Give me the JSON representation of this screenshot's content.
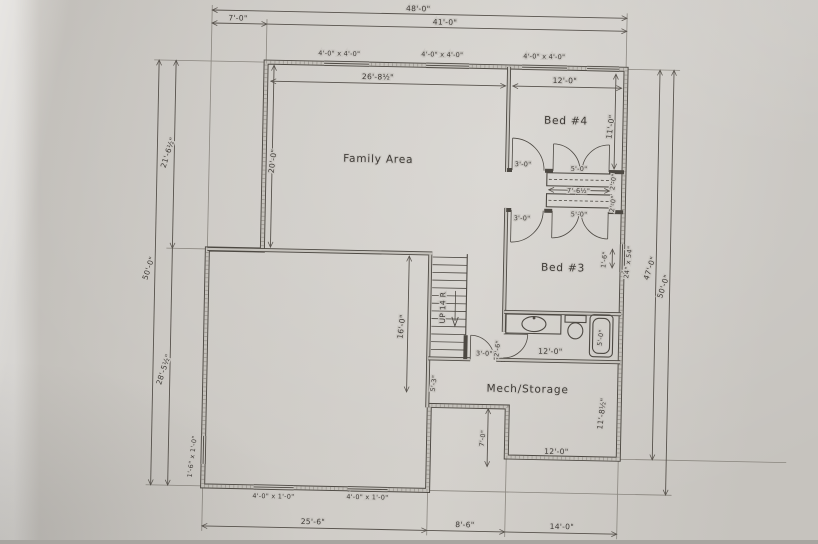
{
  "colors": {
    "paper": "#cbc8c3",
    "ink": "#4d4943",
    "text": "#3e3a36"
  },
  "plan": {
    "rooms": {
      "family_area": "Family Area",
      "bed4": "Bed #4",
      "bed3": "Bed #3",
      "mech_storage": "Mech/Storage",
      "stairs": "UP 14 R"
    },
    "dims_top": {
      "overall": "48'-0\"",
      "left": "7'-0\"",
      "right": "41'-0\""
    },
    "dims_left": {
      "overall": "50'-0\"",
      "upper": "21'-6½\"",
      "lower": "28'-5½\""
    },
    "dims_right": {
      "inner": "47'-0\"",
      "overall": "50'-0\""
    },
    "dims_bottom": {
      "left": "25'-6\"",
      "middle": "8'-6\"",
      "right": "14'-0\""
    },
    "windows": {
      "top1": "4'-0\" x 4'-0\"",
      "top2": "4'-0\" x 4'-0\"",
      "top3": "4'-0\" x 4'-0\"",
      "bottom1": "4'-0\" x 1'-0\"",
      "bottom2": "4'-0\" x 1'-0\"",
      "left": "1'-6\" x 1'-0\"",
      "bed3_egress": "24\" x 54\""
    },
    "interior_dims": {
      "family_width": "26'-8½\"",
      "family_depth": "20'-0\"",
      "bed4_width": "12'-0\"",
      "bed4_depth": "11'-0\"",
      "stair_run": "16'-0\"",
      "closet_top": "5'-0\"",
      "closet_mid": "7'-6½\"",
      "closet_bot": "5'-0\"",
      "closet_depth_a": "2'-0\"",
      "closet_depth_b": "2'-0\"",
      "bed4_door": "3'-0\"",
      "bed3_door": "3'-0\"",
      "window_offset": "1'-6\"",
      "bath_width": "12'-0\"",
      "tub_length": "5'-0\"",
      "bath_door": "2'-6\"",
      "mech_door": "3'-0\"",
      "mech_west": "5'-3\"",
      "mech_east": "11'-8½\"",
      "mech_width": "12'-0\"",
      "notch_depth": "7'-0\""
    }
  }
}
